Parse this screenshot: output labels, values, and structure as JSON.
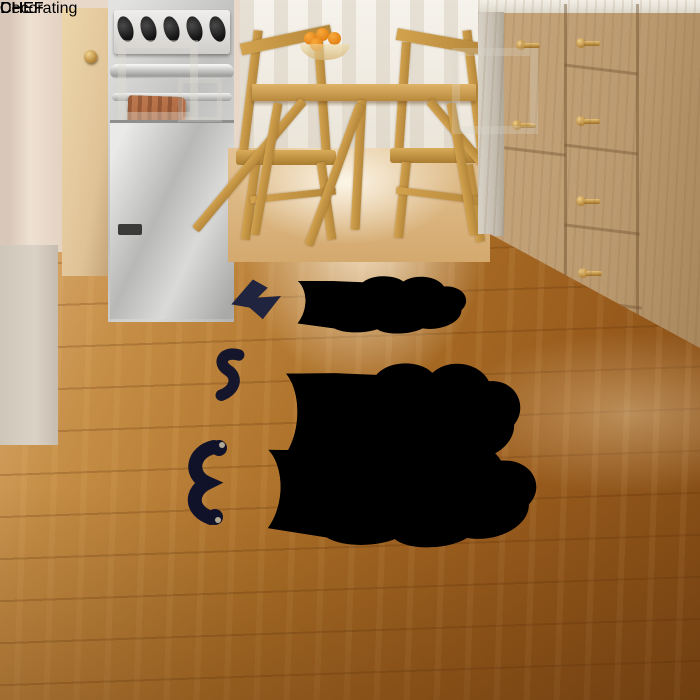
{
  "rug": {
    "labels": {
      "far": "CHEF",
      "right": "CHEF",
      "left": "CHEF",
      "near": "CHEF"
    },
    "watermark": "Decorating",
    "colors": {
      "base": "#b2a896",
      "motif_brown": "#48261a",
      "motif_cream": "#f3efe6",
      "mustache_dark": "#14162c",
      "letter_brown": "#412619",
      "edge_stitch": "#9aa0a0"
    },
    "icons": [
      "chef-hat-icon",
      "mustache-icon"
    ]
  },
  "kitchen": {
    "colors": {
      "floor_wood": "#a4671f",
      "cabinet_wood": "#c2a177",
      "brass": "#c8963f",
      "towel": "#a8613a",
      "stainless": "#c9c9c7",
      "wall": "#e8d8ca"
    }
  }
}
